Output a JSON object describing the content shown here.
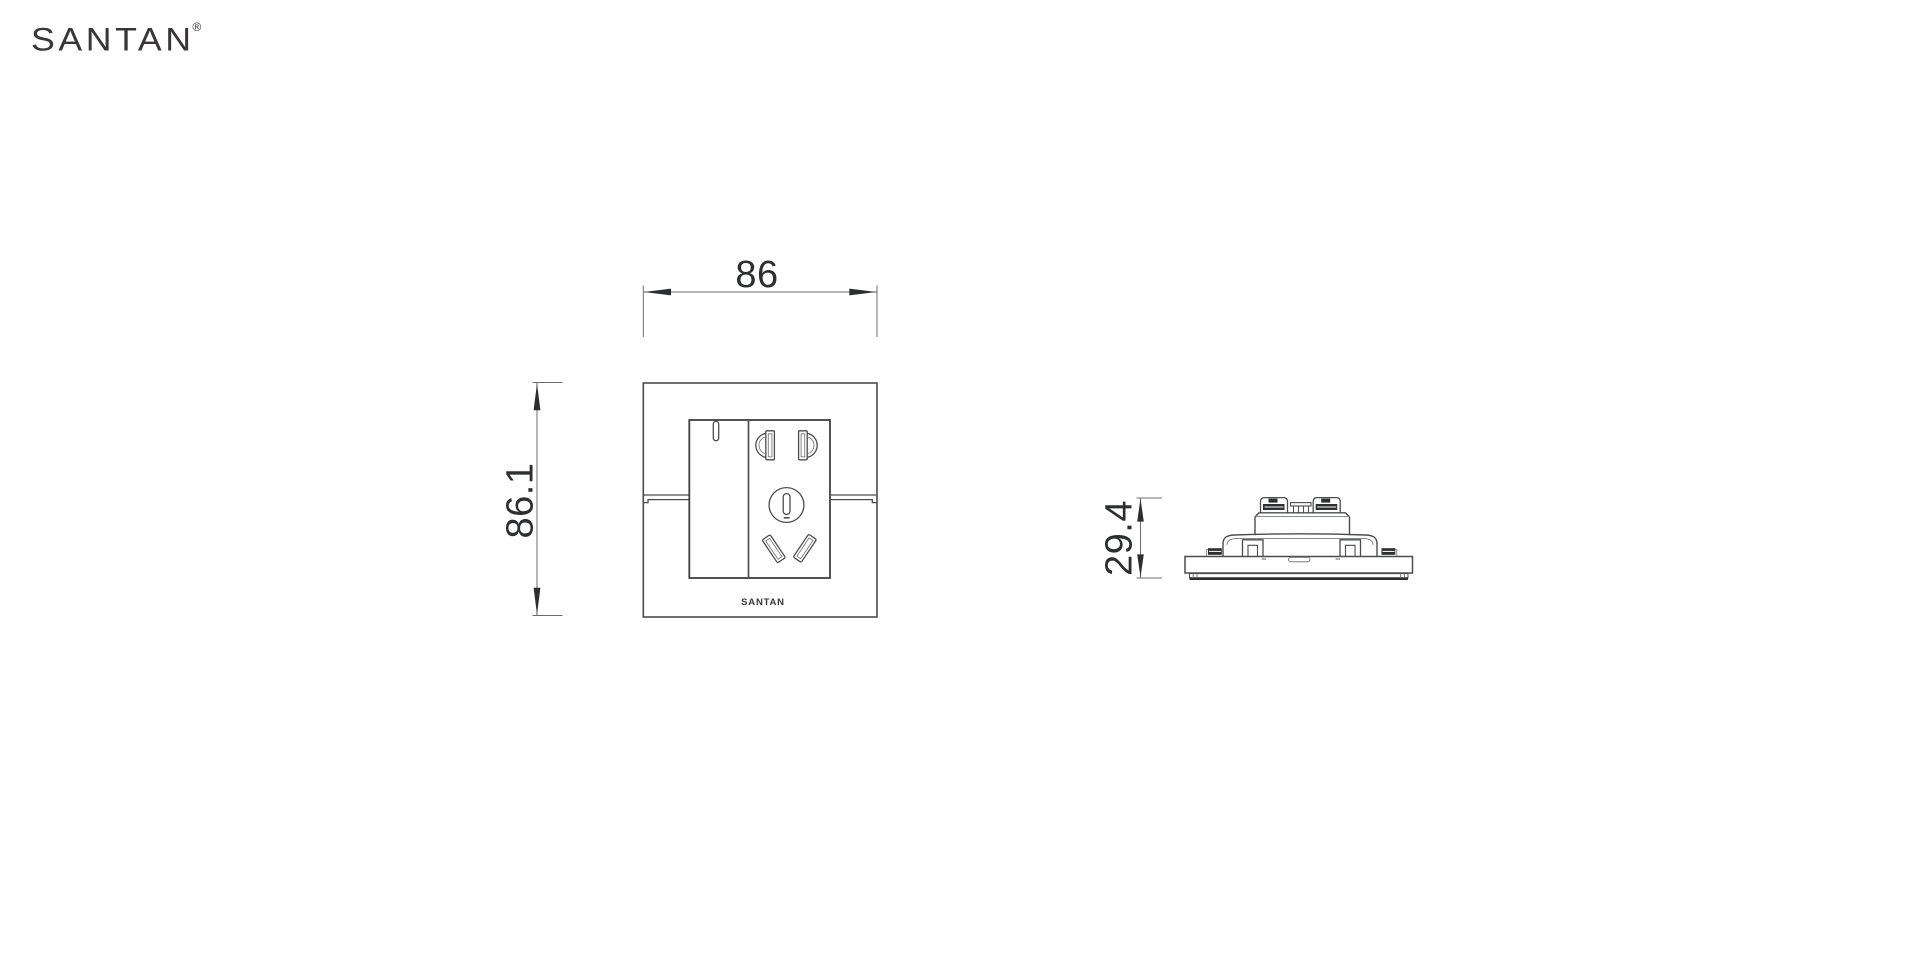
{
  "page": {
    "background_color": "#ffffff"
  },
  "brand": {
    "logo_text": "SANTAN",
    "registered_mark": "®",
    "logo_color": "#3a3637"
  },
  "drawing": {
    "kind": "product-dimension-drawing",
    "line_color": "#4b4c4e",
    "dim_line_color": "#6b6c6e",
    "dim_text_color": "#2d2e30",
    "front_view": {
      "plate_logo": "SANTAN",
      "features": [
        "outer-wall-plate",
        "switch-rocker-with-indicator",
        "five-hole-socket",
        "horizontal-plate-seam"
      ]
    },
    "side_view": {
      "features": [
        "base-plate",
        "panel-edge-strip",
        "rear-housing",
        "mounting-claws",
        "terminal-blocks-with-screws"
      ]
    },
    "dimensions": {
      "front_width": {
        "value": "86"
      },
      "front_height": {
        "value": "86.1"
      },
      "side_depth": {
        "value": "29.4"
      }
    }
  }
}
